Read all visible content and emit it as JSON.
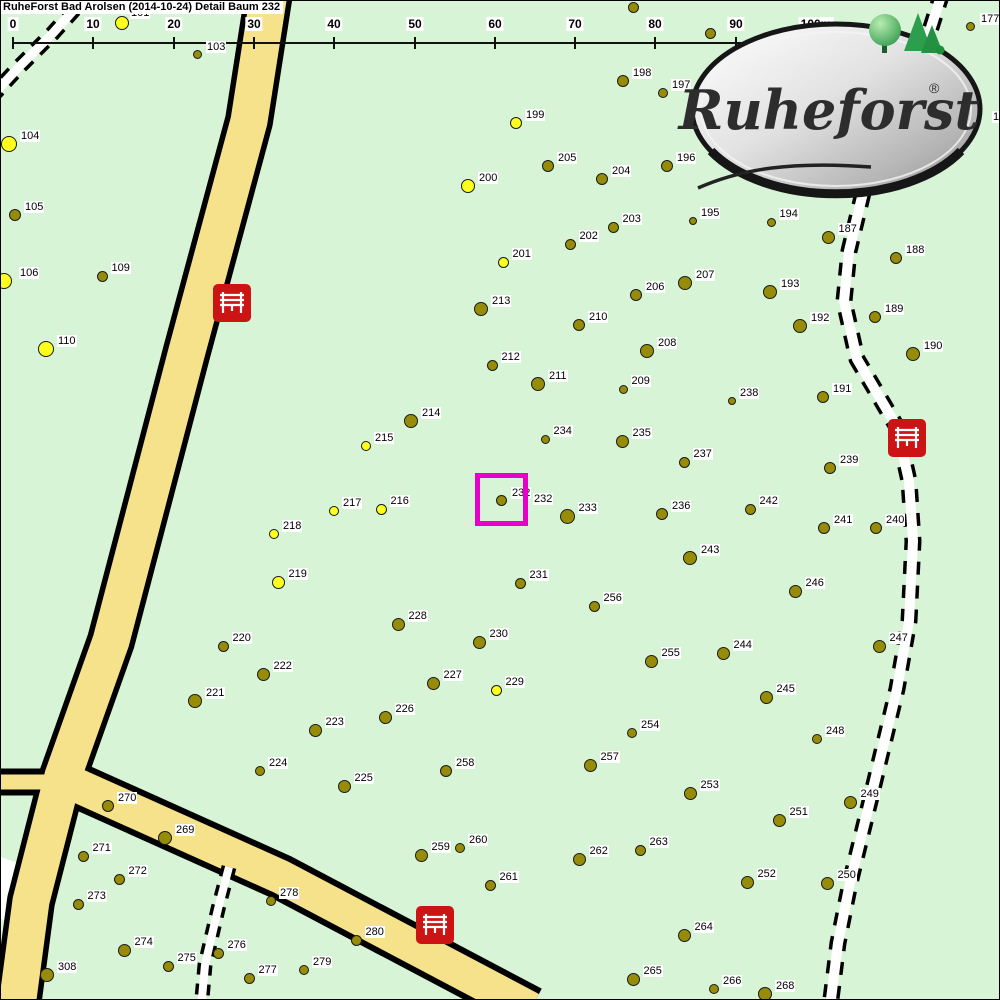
{
  "title": "RuheForst Bad Arolsen (2014-10-24) Detail  Baum 232",
  "logo": {
    "text": "Ruheforst",
    "reg": "®"
  },
  "scale": {
    "ticks": [
      "0",
      "10",
      "20",
      "30",
      "40",
      "50",
      "60",
      "70",
      "80",
      "90",
      "100m"
    ],
    "x0": 12,
    "dx": 80.3,
    "y_line": 41,
    "y_tick": 36,
    "y_label": 16
  },
  "colors": {
    "background": "#d7f4d7",
    "road_fill": "#f5e28a",
    "road_casing": "#000000",
    "trail_white": "#ffffff",
    "tree_olive": "#978c08",
    "tree_yellow": "#ffff1e",
    "bench_red": "#cc1414",
    "highlight": "#e800c8",
    "label_bg": "#ffffff"
  },
  "map": {
    "highlight": {
      "tree": "232",
      "x": 474,
      "y": 472,
      "w": 53,
      "h": 53,
      "stroke": 5,
      "outer_label": {
        "text": "232",
        "x": 532,
        "y": 492
      }
    },
    "white_area": [
      [
        0,
        856
      ],
      [
        22,
        864
      ],
      [
        7,
        920
      ],
      [
        0,
        918
      ]
    ],
    "roads": [
      {
        "pts": [
          [
            268,
            -8
          ],
          [
            248,
            120
          ],
          [
            186,
            350
          ],
          [
            110,
            640
          ],
          [
            62,
            775
          ],
          [
            30,
            900
          ],
          [
            16,
            1005
          ]
        ],
        "casing": 48,
        "fill": 37
      },
      {
        "pts": [
          [
            55,
            775
          ],
          [
            280,
            876
          ],
          [
            530,
            1008
          ]
        ],
        "casing": 46,
        "fill": 34
      },
      {
        "pts": [
          [
            -6,
            781
          ],
          [
            70,
            781
          ]
        ],
        "casing": 27,
        "fill": 15
      }
    ],
    "trails": [
      {
        "pts": [
          [
            88,
            -8
          ],
          [
            52,
            32
          ],
          [
            16,
            68
          ],
          [
            -8,
            94
          ]
        ],
        "w": 9,
        "dash": "12 10"
      },
      {
        "pts": [
          [
            941,
            -8
          ],
          [
            925,
            42
          ],
          [
            885,
            125
          ],
          [
            872,
            150
          ],
          [
            848,
            250
          ],
          [
            843,
            300
          ],
          [
            856,
            358
          ],
          [
            896,
            426
          ],
          [
            908,
            480
          ],
          [
            912,
            540
          ],
          [
            908,
            620
          ],
          [
            896,
            688
          ],
          [
            869,
            800
          ],
          [
            849,
            882
          ],
          [
            837,
            942
          ],
          [
            829,
            1006
          ]
        ],
        "w": 10,
        "dash": "13 11"
      },
      {
        "pts": [
          [
            228,
            866
          ],
          [
            217,
            908
          ],
          [
            204,
            964
          ],
          [
            200,
            1008
          ]
        ],
        "w": 8,
        "dash": "11 9"
      }
    ],
    "benches": [
      [
        231,
        301
      ],
      [
        906,
        436
      ],
      [
        434,
        923
      ]
    ],
    "trees": [
      [
        "101",
        121,
        22,
        "y",
        7,
        129,
        6
      ],
      [
        "103",
        196,
        53,
        "o",
        4.5,
        205,
        40
      ],
      [
        "171",
        632,
        6,
        "o",
        5.5,
        641,
        -12
      ],
      [
        "",
        709,
        32,
        "o",
        5.5
      ],
      [
        "177",
        969,
        25,
        "o",
        4.5,
        979,
        12
      ],
      [
        "104",
        8,
        143,
        "y",
        8
      ],
      [
        "105",
        14,
        214,
        "o",
        6
      ],
      [
        "106",
        3,
        280,
        "y",
        8,
        18,
        266
      ],
      [
        "109",
        101,
        275,
        "o",
        5.5
      ],
      [
        "110",
        45,
        348,
        "y",
        8
      ],
      [
        "198",
        622,
        80,
        "o",
        6
      ],
      [
        "197",
        662,
        92,
        "o",
        5
      ],
      [
        "199",
        515,
        122,
        "y",
        6
      ],
      [
        "205",
        547,
        165,
        "o",
        6
      ],
      [
        "204",
        601,
        178,
        "o",
        6
      ],
      [
        "196",
        666,
        165,
        "o",
        6
      ],
      [
        "200",
        467,
        185,
        "y",
        7
      ],
      [
        "203",
        612,
        226,
        "o",
        5.5
      ],
      [
        "202",
        569,
        243,
        "o",
        5.5
      ],
      [
        "201",
        502,
        261,
        "y",
        5.5
      ],
      [
        "195",
        692,
        220,
        "o",
        4
      ],
      [
        "194",
        770,
        221,
        "o",
        4.5
      ],
      [
        "187",
        827,
        236,
        "o",
        6.5
      ],
      [
        "188",
        895,
        257,
        "o",
        6
      ],
      [
        "193",
        769,
        291,
        "o",
        7
      ],
      [
        "189",
        874,
        316,
        "o",
        6
      ],
      [
        "192",
        799,
        325,
        "o",
        7
      ],
      [
        "190",
        912,
        353,
        "o",
        7
      ],
      [
        "191",
        822,
        396,
        "o",
        6
      ],
      [
        "238",
        731,
        400,
        "o",
        4
      ],
      [
        "207",
        684,
        282,
        "o",
        7
      ],
      [
        "206",
        635,
        294,
        "o",
        6
      ],
      [
        "213",
        480,
        308,
        "o",
        7
      ],
      [
        "210",
        578,
        324,
        "o",
        6
      ],
      [
        "208",
        646,
        350,
        "o",
        7
      ],
      [
        "212",
        491,
        364,
        "o",
        5.5
      ],
      [
        "211",
        537,
        383,
        "o",
        7
      ],
      [
        "209",
        622,
        388,
        "o",
        4.5
      ],
      [
        "214",
        410,
        420,
        "o",
        7
      ],
      [
        "215",
        365,
        445,
        "y",
        5
      ],
      [
        "234",
        544,
        438,
        "o",
        4.5
      ],
      [
        "235",
        621,
        440,
        "o",
        6.5
      ],
      [
        "237",
        683,
        461,
        "o",
        5.5
      ],
      [
        "239",
        829,
        467,
        "o",
        6
      ],
      [
        "217",
        333,
        510,
        "y",
        5
      ],
      [
        "216",
        380,
        508,
        "y",
        5.5
      ],
      [
        "232",
        500,
        499,
        "o",
        5.5,
        510,
        486
      ],
      [
        "233",
        566,
        515,
        "o",
        7.5
      ],
      [
        "231",
        519,
        582,
        "o",
        5.5
      ],
      [
        "218",
        273,
        533,
        "y",
        5
      ],
      [
        "219",
        277,
        581,
        "y",
        6.5
      ],
      [
        "236",
        661,
        513,
        "o",
        6
      ],
      [
        "242",
        749,
        508,
        "o",
        5.5
      ],
      [
        "241",
        823,
        527,
        "o",
        6
      ],
      [
        "240",
        875,
        527,
        "o",
        6
      ],
      [
        "243",
        689,
        557,
        "o",
        7
      ],
      [
        "246",
        794,
        590,
        "o",
        6.5
      ],
      [
        "256",
        593,
        605,
        "o",
        5.5
      ],
      [
        "228",
        397,
        623,
        "o",
        6.5
      ],
      [
        "230",
        478,
        641,
        "o",
        6.5
      ],
      [
        "220",
        222,
        645,
        "o",
        5.5
      ],
      [
        "222",
        262,
        673,
        "o",
        6.5
      ],
      [
        "227",
        432,
        682,
        "o",
        6.5
      ],
      [
        "229",
        495,
        689,
        "y",
        5.5
      ],
      [
        "221",
        194,
        700,
        "o",
        7
      ],
      [
        "226",
        384,
        716,
        "o",
        6.5
      ],
      [
        "223",
        314,
        729,
        "o",
        6.5
      ],
      [
        "255",
        650,
        660,
        "o",
        6.5
      ],
      [
        "244",
        722,
        652,
        "o",
        6.5
      ],
      [
        "247",
        878,
        645,
        "o",
        6.5
      ],
      [
        "245",
        765,
        696,
        "o",
        6.5
      ],
      [
        "254",
        631,
        732,
        "o",
        5
      ],
      [
        "248",
        816,
        738,
        "o",
        5
      ],
      [
        "257",
        589,
        764,
        "o",
        6.5
      ],
      [
        "224",
        259,
        770,
        "o",
        5
      ],
      [
        "225",
        343,
        785,
        "o",
        6.5
      ],
      [
        "258",
        445,
        770,
        "o",
        6
      ],
      [
        "253",
        689,
        792,
        "o",
        6.5
      ],
      [
        "249",
        849,
        801,
        "o",
        6.5
      ],
      [
        "251",
        778,
        819,
        "o",
        6.5
      ],
      [
        "270",
        107,
        805,
        "o",
        6
      ],
      [
        "269",
        164,
        837,
        "o",
        7
      ],
      [
        "271",
        82,
        855,
        "o",
        5.5
      ],
      [
        "272",
        118,
        878,
        "o",
        5.5
      ],
      [
        "273",
        77,
        903,
        "o",
        5.5
      ],
      [
        "263",
        639,
        849,
        "o",
        5.5
      ],
      [
        "262",
        578,
        858,
        "o",
        6.5
      ],
      [
        "259",
        420,
        854,
        "o",
        6.5
      ],
      [
        "260",
        459,
        847,
        "o",
        5
      ],
      [
        "261",
        489,
        884,
        "o",
        5.5
      ],
      [
        "252",
        746,
        881,
        "o",
        6.5
      ],
      [
        "250",
        826,
        882,
        "o",
        6.5
      ],
      [
        "264",
        683,
        934,
        "o",
        6.5
      ],
      [
        "274",
        123,
        949,
        "o",
        6.5
      ],
      [
        "275",
        167,
        965,
        "o",
        5.5
      ],
      [
        "308",
        46,
        974,
        "o",
        7
      ],
      [
        "276",
        217,
        952,
        "o",
        5.5
      ],
      [
        "277",
        248,
        977,
        "o",
        5.5
      ],
      [
        "278",
        270,
        900,
        "o",
        5
      ],
      [
        "279",
        303,
        969,
        "o",
        5
      ],
      [
        "280",
        355,
        939,
        "o",
        5.5
      ],
      [
        "265",
        632,
        978,
        "o",
        6.5
      ],
      [
        "266",
        713,
        988,
        "o",
        5
      ],
      [
        "268",
        764,
        993,
        "o",
        7
      ]
    ],
    "extra_labels": [
      {
        "text": "17",
        "x": 991,
        "y": 110
      }
    ]
  }
}
